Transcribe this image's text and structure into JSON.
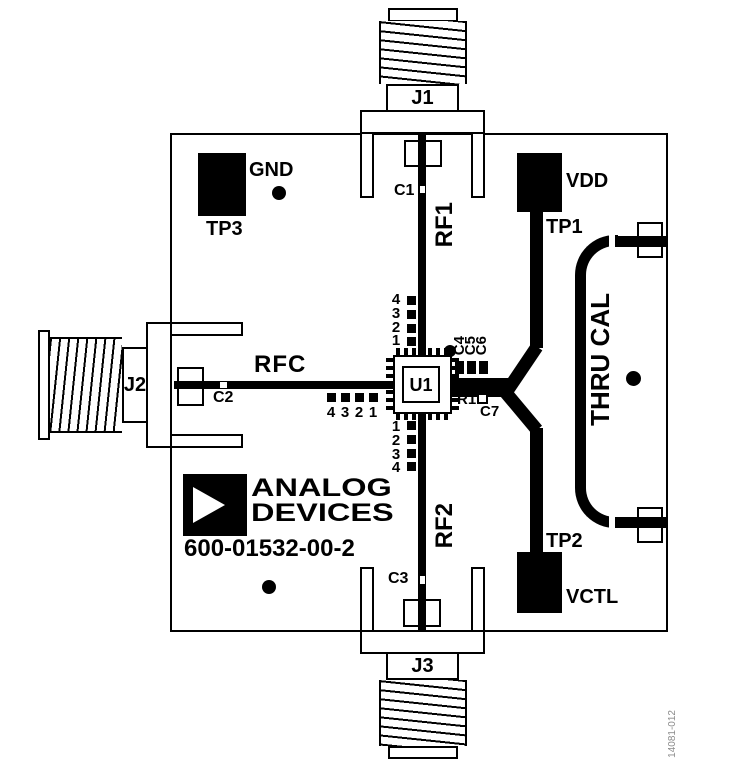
{
  "board": {
    "part_number": "600-01532-00-2",
    "figure_id": "14081-012"
  },
  "brand": {
    "line1": "ANALOG",
    "line2": "DEVICES"
  },
  "connectors": {
    "j1": "J1",
    "j2": "J2",
    "j3": "J3"
  },
  "test_points": {
    "tp1": {
      "ref": "TP1",
      "net": "VDD"
    },
    "tp2": {
      "ref": "TP2",
      "net": "VCTL"
    },
    "tp3": {
      "ref": "TP3",
      "net": "GND"
    }
  },
  "ic": {
    "ref": "U1"
  },
  "components": {
    "c1": "C1",
    "c2": "C2",
    "c3": "C3",
    "c4": "C4",
    "c5": "C5",
    "c6": "C6",
    "c7": "C7",
    "r1": "R1"
  },
  "nets": {
    "rf1": "RF1",
    "rf2": "RF2",
    "rfc": "RFC",
    "thru_cal": "THRU CAL"
  },
  "pad_groups": {
    "top": [
      "4",
      "3",
      "2",
      "1"
    ],
    "left": [
      "4",
      "3",
      "2",
      "1"
    ],
    "bottom": [
      "1",
      "2",
      "3",
      "4"
    ]
  },
  "colors": {
    "silkscreen": "#000000",
    "board": "#ffffff",
    "figure_note": "#8c8c8c"
  }
}
